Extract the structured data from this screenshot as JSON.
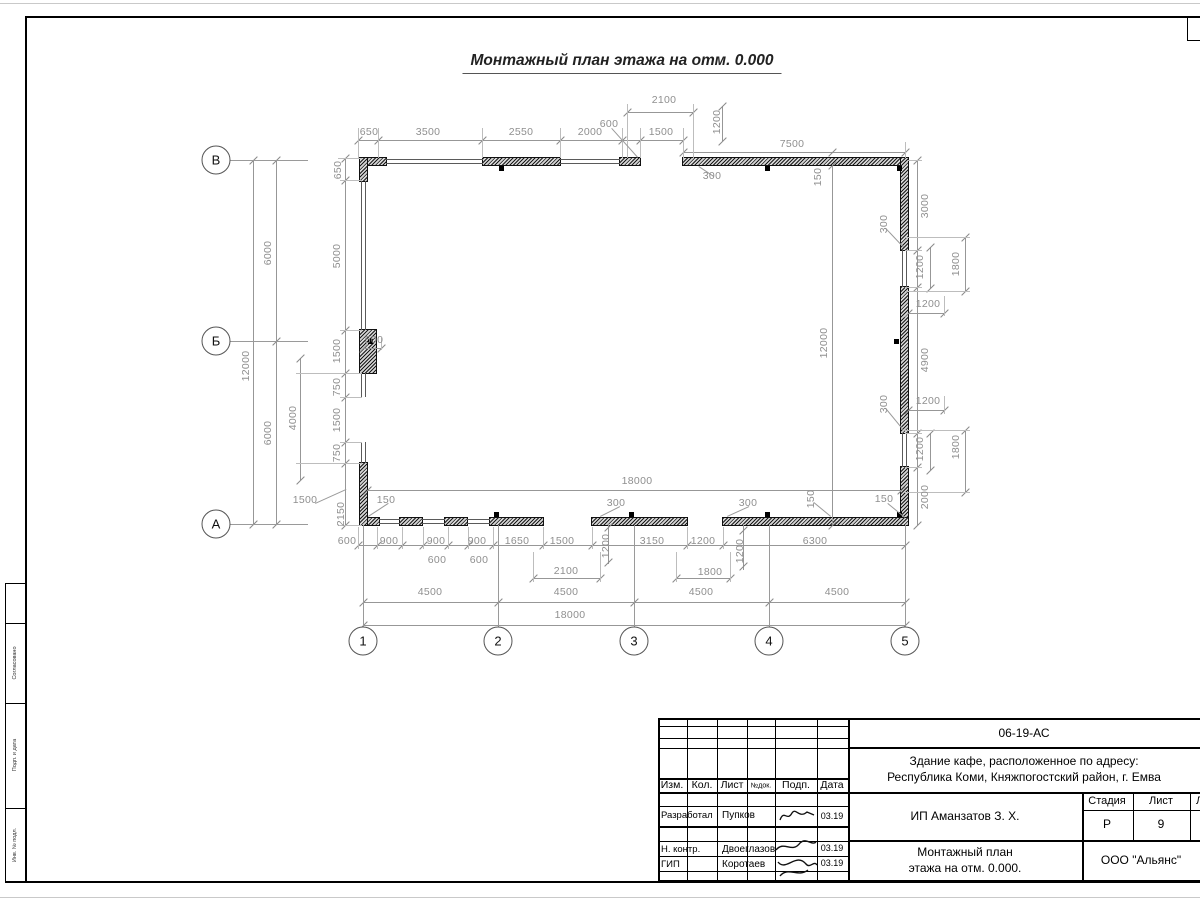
{
  "meta": {
    "title": "Монтажный план этажа на отм. 0.000"
  },
  "axes": {
    "rows": [
      {
        "label": "В",
        "cy": 160
      },
      {
        "label": "Б",
        "cy": 341
      },
      {
        "label": "А",
        "cy": 524
      }
    ],
    "rows_cx": 216,
    "cols": [
      {
        "label": "1",
        "cx": 363
      },
      {
        "label": "2",
        "cx": 498
      },
      {
        "label": "3",
        "cx": 634
      },
      {
        "label": "4",
        "cx": 769
      },
      {
        "label": "5",
        "cx": 905
      }
    ],
    "cols_cy": 641
  },
  "plan": {
    "walls": [
      [
        360,
        158,
        26,
        7
      ],
      [
        360,
        158,
        7,
        23
      ],
      [
        483,
        158,
        77,
        7
      ],
      [
        620,
        158,
        20,
        7
      ],
      [
        683,
        158,
        225,
        7
      ],
      [
        901,
        158,
        7,
        92
      ],
      [
        901,
        287,
        7,
        146
      ],
      [
        901,
        467,
        7,
        58
      ],
      [
        360,
        518,
        19,
        7
      ],
      [
        400,
        518,
        22,
        7
      ],
      [
        445,
        518,
        22,
        7
      ],
      [
        490,
        518,
        53,
        7
      ],
      [
        592,
        518,
        95,
        7
      ],
      [
        723,
        518,
        185,
        7
      ],
      [
        360,
        330,
        16,
        43
      ],
      [
        360,
        463,
        7,
        62
      ]
    ],
    "windows": [
      {
        "o": "h",
        "x": 386,
        "y": 159,
        "len": 97
      },
      {
        "o": "h",
        "x": 560,
        "y": 159,
        "len": 60
      },
      {
        "o": "v",
        "x": 361,
        "y": 181,
        "len": 149
      },
      {
        "o": "v",
        "x": 361,
        "y": 373,
        "len": 24
      },
      {
        "o": "v",
        "x": 361,
        "y": 442,
        "len": 21
      },
      {
        "o": "v",
        "x": 902,
        "y": 250,
        "len": 37
      },
      {
        "o": "v",
        "x": 902,
        "y": 433,
        "len": 34
      },
      {
        "o": "h",
        "x": 379,
        "y": 519,
        "len": 21
      },
      {
        "o": "h",
        "x": 422,
        "y": 519,
        "len": 23
      },
      {
        "o": "h",
        "x": 467,
        "y": 519,
        "len": 23
      }
    ],
    "columns": [
      [
        499,
        166
      ],
      [
        765,
        166
      ],
      [
        897,
        166
      ],
      [
        368,
        339
      ],
      [
        894,
        339
      ],
      [
        494,
        512
      ],
      [
        629,
        512
      ],
      [
        765,
        512
      ],
      [
        897,
        512
      ]
    ],
    "dimlines": [
      {
        "o": "h",
        "x": 627,
        "y": 112,
        "len": 66,
        "ticks": [
          627,
          693
        ]
      },
      {
        "o": "h",
        "x": 358,
        "y": 140,
        "len": 325,
        "ticks": [
          358,
          378,
          482,
          560,
          622,
          640,
          683
        ]
      },
      {
        "o": "h",
        "x": 683,
        "y": 152,
        "len": 222,
        "ticks": [
          683,
          832,
          905
        ]
      },
      {
        "o": "v",
        "x": 722,
        "y": 106,
        "len": 35,
        "ticks": [
          106,
          141
        ]
      },
      {
        "o": "h",
        "x": 363,
        "y": 348,
        "len": 18,
        "ticks": [
          363,
          381
        ]
      },
      {
        "o": "v",
        "x": 345,
        "y": 158,
        "len": 367,
        "ticks": [
          158,
          180,
          330,
          373,
          397,
          442,
          463,
          525
        ]
      },
      {
        "o": "v",
        "x": 300,
        "y": 358,
        "len": 122,
        "ticks": [
          358,
          480
        ]
      },
      {
        "o": "v",
        "x": 276,
        "y": 160,
        "len": 364,
        "ticks": [
          160,
          341,
          524
        ]
      },
      {
        "o": "v",
        "x": 253,
        "y": 160,
        "len": 364,
        "ticks": [
          160,
          524
        ]
      },
      {
        "o": "v",
        "x": 917,
        "y": 160,
        "len": 365,
        "ticks": [
          160,
          250,
          287,
          433,
          467,
          525
        ]
      },
      {
        "o": "v",
        "x": 930,
        "y": 247,
        "len": 41,
        "ticks": [
          247,
          288
        ]
      },
      {
        "o": "v",
        "x": 965,
        "y": 237,
        "len": 54,
        "ticks": [
          237,
          291
        ]
      },
      {
        "o": "h",
        "x": 908,
        "y": 313,
        "len": 36,
        "ticks": [
          908,
          944
        ]
      },
      {
        "o": "v",
        "x": 930,
        "y": 433,
        "len": 37,
        "ticks": [
          433,
          470
        ]
      },
      {
        "o": "v",
        "x": 965,
        "y": 430,
        "len": 62,
        "ticks": [
          430,
          492
        ]
      },
      {
        "o": "h",
        "x": 908,
        "y": 410,
        "len": 36,
        "ticks": [
          908,
          944
        ]
      },
      {
        "o": "h",
        "x": 367,
        "y": 490,
        "len": 534,
        "ticks": [
          367,
          901
        ]
      },
      {
        "o": "h",
        "x": 358,
        "y": 545,
        "len": 547,
        "ticks": [
          358,
          377,
          402,
          423,
          448,
          468,
          493,
          543,
          592,
          687,
          723,
          905
        ]
      },
      {
        "o": "h",
        "x": 533,
        "y": 578,
        "len": 67,
        "ticks": [
          533,
          600
        ]
      },
      {
        "o": "h",
        "x": 676,
        "y": 578,
        "len": 54,
        "ticks": [
          676,
          730
        ]
      },
      {
        "o": "h",
        "x": 363,
        "y": 602,
        "len": 542,
        "ticks": [
          363,
          498,
          634,
          769,
          905
        ]
      },
      {
        "o": "h",
        "x": 363,
        "y": 625,
        "len": 542,
        "ticks": [
          363,
          905
        ]
      },
      {
        "o": "v",
        "x": 832,
        "y": 165,
        "len": 360,
        "ticks": [
          165,
          525
        ]
      },
      {
        "o": "v",
        "x": 608,
        "y": 524,
        "len": 40,
        "ticks": [
          527,
          562
        ]
      },
      {
        "o": "v",
        "x": 743,
        "y": 524,
        "len": 46,
        "ticks": [
          530,
          566
        ]
      }
    ],
    "extlines": [
      {
        "o": "v",
        "x": 358,
        "y": 128,
        "len": 30
      },
      {
        "o": "v",
        "x": 378,
        "y": 128,
        "len": 30
      },
      {
        "o": "v",
        "x": 482,
        "y": 128,
        "len": 30
      },
      {
        "o": "v",
        "x": 560,
        "y": 128,
        "len": 30
      },
      {
        "o": "v",
        "x": 622,
        "y": 128,
        "len": 30
      },
      {
        "o": "v",
        "x": 640,
        "y": 128,
        "len": 30
      },
      {
        "o": "v",
        "x": 683,
        "y": 128,
        "len": 32
      },
      {
        "o": "v",
        "x": 627,
        "y": 104,
        "len": 54
      },
      {
        "o": "v",
        "x": 693,
        "y": 104,
        "len": 54
      },
      {
        "o": "v",
        "x": 905,
        "y": 142,
        "len": 16
      },
      {
        "o": "h",
        "x": 905,
        "y": 250,
        "len": 17
      },
      {
        "o": "h",
        "x": 905,
        "y": 287,
        "len": 17
      },
      {
        "o": "h",
        "x": 905,
        "y": 433,
        "len": 17
      },
      {
        "o": "h",
        "x": 905,
        "y": 467,
        "len": 17
      },
      {
        "o": "h",
        "x": 905,
        "y": 237,
        "len": 65
      },
      {
        "o": "h",
        "x": 905,
        "y": 291,
        "len": 65
      },
      {
        "o": "h",
        "x": 905,
        "y": 430,
        "len": 65
      },
      {
        "o": "h",
        "x": 905,
        "y": 492,
        "len": 65
      },
      {
        "o": "h",
        "x": 908,
        "y": 160,
        "len": 14
      },
      {
        "o": "h",
        "x": 340,
        "y": 180,
        "len": 22
      },
      {
        "o": "h",
        "x": 340,
        "y": 330,
        "len": 22
      },
      {
        "o": "h",
        "x": 296,
        "y": 373,
        "len": 66
      },
      {
        "o": "h",
        "x": 340,
        "y": 397,
        "len": 22
      },
      {
        "o": "h",
        "x": 340,
        "y": 442,
        "len": 22
      },
      {
        "o": "h",
        "x": 296,
        "y": 463,
        "len": 66
      },
      {
        "o": "h",
        "x": 338,
        "y": 158,
        "len": 24
      },
      {
        "o": "h",
        "x": 338,
        "y": 525,
        "len": 24
      },
      {
        "o": "v",
        "x": 358,
        "y": 527,
        "len": 22
      },
      {
        "o": "v",
        "x": 377,
        "y": 527,
        "len": 22
      },
      {
        "o": "v",
        "x": 402,
        "y": 527,
        "len": 22
      },
      {
        "o": "v",
        "x": 423,
        "y": 527,
        "len": 22
      },
      {
        "o": "v",
        "x": 448,
        "y": 527,
        "len": 22
      },
      {
        "o": "v",
        "x": 468,
        "y": 527,
        "len": 22
      },
      {
        "o": "v",
        "x": 493,
        "y": 527,
        "len": 22
      },
      {
        "o": "v",
        "x": 543,
        "y": 527,
        "len": 22
      },
      {
        "o": "v",
        "x": 592,
        "y": 527,
        "len": 22
      },
      {
        "o": "v",
        "x": 687,
        "y": 527,
        "len": 22
      },
      {
        "o": "v",
        "x": 723,
        "y": 527,
        "len": 22
      },
      {
        "o": "v",
        "x": 533,
        "y": 552,
        "len": 30
      },
      {
        "o": "v",
        "x": 600,
        "y": 552,
        "len": 30
      },
      {
        "o": "v",
        "x": 676,
        "y": 552,
        "len": 30
      },
      {
        "o": "v",
        "x": 730,
        "y": 552,
        "len": 30
      },
      {
        "o": "v",
        "x": 944,
        "y": 296,
        "len": 20
      },
      {
        "o": "v",
        "x": 944,
        "y": 396,
        "len": 18
      },
      {
        "o": "v",
        "x": 381,
        "y": 338,
        "len": 12
      }
    ],
    "leaders": [
      [
        612,
        128,
        638,
        157
      ],
      [
        699,
        166,
        714,
        176
      ],
      [
        886,
        228,
        904,
        247
      ],
      [
        886,
        408,
        904,
        430
      ],
      [
        888,
        503,
        905,
        517
      ],
      [
        600,
        516,
        620,
        506
      ],
      [
        727,
        516,
        749,
        506
      ],
      [
        368,
        516,
        388,
        503
      ],
      [
        315,
        503,
        346,
        489
      ],
      [
        814,
        502,
        831,
        516
      ]
    ],
    "labels": [
      {
        "t": "2100",
        "x": 664,
        "y": 100
      },
      {
        "t": "1200",
        "x": 717,
        "y": 122,
        "r": 1
      },
      {
        "t": "600",
        "x": 609,
        "y": 124
      },
      {
        "t": "650",
        "x": 369,
        "y": 132
      },
      {
        "t": "3500",
        "x": 428,
        "y": 132
      },
      {
        "t": "2550",
        "x": 521,
        "y": 132
      },
      {
        "t": "2000",
        "x": 590,
        "y": 132
      },
      {
        "t": "1500",
        "x": 661,
        "y": 132
      },
      {
        "t": "7500",
        "x": 792,
        "y": 144
      },
      {
        "t": "300",
        "x": 712,
        "y": 176
      },
      {
        "t": "650",
        "x": 338,
        "y": 170,
        "r": 1
      },
      {
        "t": "150",
        "x": 818,
        "y": 177,
        "r": 1
      },
      {
        "t": "3000",
        "x": 925,
        "y": 206,
        "r": 1
      },
      {
        "t": "300",
        "x": 884,
        "y": 224,
        "r": 1
      },
      {
        "t": "1200",
        "x": 920,
        "y": 267,
        "r": 1
      },
      {
        "t": "1800",
        "x": 956,
        "y": 264,
        "r": 1
      },
      {
        "t": "1200",
        "x": 928,
        "y": 304
      },
      {
        "t": "5000",
        "x": 337,
        "y": 256,
        "r": 1
      },
      {
        "t": "6000",
        "x": 268,
        "y": 253,
        "r": 1
      },
      {
        "t": "12000",
        "x": 246,
        "y": 366,
        "r": 1
      },
      {
        "t": "12000",
        "x": 824,
        "y": 343,
        "r": 1
      },
      {
        "t": "4900",
        "x": 925,
        "y": 360,
        "r": 1
      },
      {
        "t": "1500",
        "x": 337,
        "y": 351,
        "r": 1
      },
      {
        "t": "500",
        "x": 374,
        "y": 340
      },
      {
        "t": "750",
        "x": 337,
        "y": 387,
        "r": 1
      },
      {
        "t": "1500",
        "x": 337,
        "y": 420,
        "r": 1
      },
      {
        "t": "750",
        "x": 337,
        "y": 453,
        "r": 1
      },
      {
        "t": "4000",
        "x": 293,
        "y": 418,
        "r": 1
      },
      {
        "t": "6000",
        "x": 268,
        "y": 433,
        "r": 1
      },
      {
        "t": "300",
        "x": 884,
        "y": 404,
        "r": 1
      },
      {
        "t": "1200",
        "x": 928,
        "y": 401
      },
      {
        "t": "1200",
        "x": 920,
        "y": 449,
        "r": 1
      },
      {
        "t": "1800",
        "x": 956,
        "y": 447,
        "r": 1
      },
      {
        "t": "2000",
        "x": 925,
        "y": 497,
        "r": 1
      },
      {
        "t": "150",
        "x": 884,
        "y": 499
      },
      {
        "t": "150",
        "x": 811,
        "y": 499,
        "r": 1
      },
      {
        "t": "18000",
        "x": 637,
        "y": 481
      },
      {
        "t": "1500",
        "x": 305,
        "y": 500
      },
      {
        "t": "2150",
        "x": 341,
        "y": 514,
        "r": 1
      },
      {
        "t": "150",
        "x": 386,
        "y": 500
      },
      {
        "t": "300",
        "x": 616,
        "y": 503
      },
      {
        "t": "300",
        "x": 748,
        "y": 503
      },
      {
        "t": "600",
        "x": 347,
        "y": 541
      },
      {
        "t": "900",
        "x": 389,
        "y": 541
      },
      {
        "t": "900",
        "x": 436,
        "y": 541
      },
      {
        "t": "900",
        "x": 477,
        "y": 541
      },
      {
        "t": "1650",
        "x": 517,
        "y": 541
      },
      {
        "t": "1500",
        "x": 562,
        "y": 541
      },
      {
        "t": "1200",
        "x": 606,
        "y": 546,
        "r": 1
      },
      {
        "t": "3150",
        "x": 652,
        "y": 541
      },
      {
        "t": "1200",
        "x": 703,
        "y": 541
      },
      {
        "t": "1200",
        "x": 740,
        "y": 551,
        "r": 1
      },
      {
        "t": "6300",
        "x": 815,
        "y": 541
      },
      {
        "t": "600",
        "x": 437,
        "y": 560
      },
      {
        "t": "600",
        "x": 479,
        "y": 560
      },
      {
        "t": "2100",
        "x": 566,
        "y": 571
      },
      {
        "t": "1800",
        "x": 710,
        "y": 572
      },
      {
        "t": "4500",
        "x": 430,
        "y": 592
      },
      {
        "t": "4500",
        "x": 566,
        "y": 592
      },
      {
        "t": "4500",
        "x": 701,
        "y": 592
      },
      {
        "t": "4500",
        "x": 837,
        "y": 592
      },
      {
        "t": "18000",
        "x": 570,
        "y": 615
      }
    ]
  },
  "titleblock": {
    "doc_code": "06-19-АС",
    "object_line1": "Здание кафе, расположенное по адресу:",
    "object_line2": "Республика Коми, Княжпогостский район, г. Емва",
    "header": {
      "izm": "Изм.",
      "kol": "Кол.",
      "list": "Лист",
      "ndoc": "№док.",
      "podp": "Подп.",
      "data": "Дата"
    },
    "rows": [
      {
        "role": "Разработал",
        "name": "Пупков",
        "date": "03.19"
      },
      {
        "role": "Н. контр.",
        "name": "Двоеглазов",
        "date": "03.19"
      },
      {
        "role": "ГИП",
        "name": "Коротаев",
        "date": "03.19"
      }
    ],
    "client": "ИП Аманзатов З. Х.",
    "stage_label": "Стадия",
    "sheet_label": "Лист",
    "sheets_label": "Листов",
    "stage": "Р",
    "sheet": "9",
    "sheet_title_line1": "Монтажный план",
    "sheet_title_line2": "этажа на отм. 0.000.",
    "company": "ООО \"Альянс\""
  },
  "left_strip": {
    "boxes": [
      "",
      "Согласовано",
      "Подп. и дата",
      "Инв. № подл."
    ]
  }
}
